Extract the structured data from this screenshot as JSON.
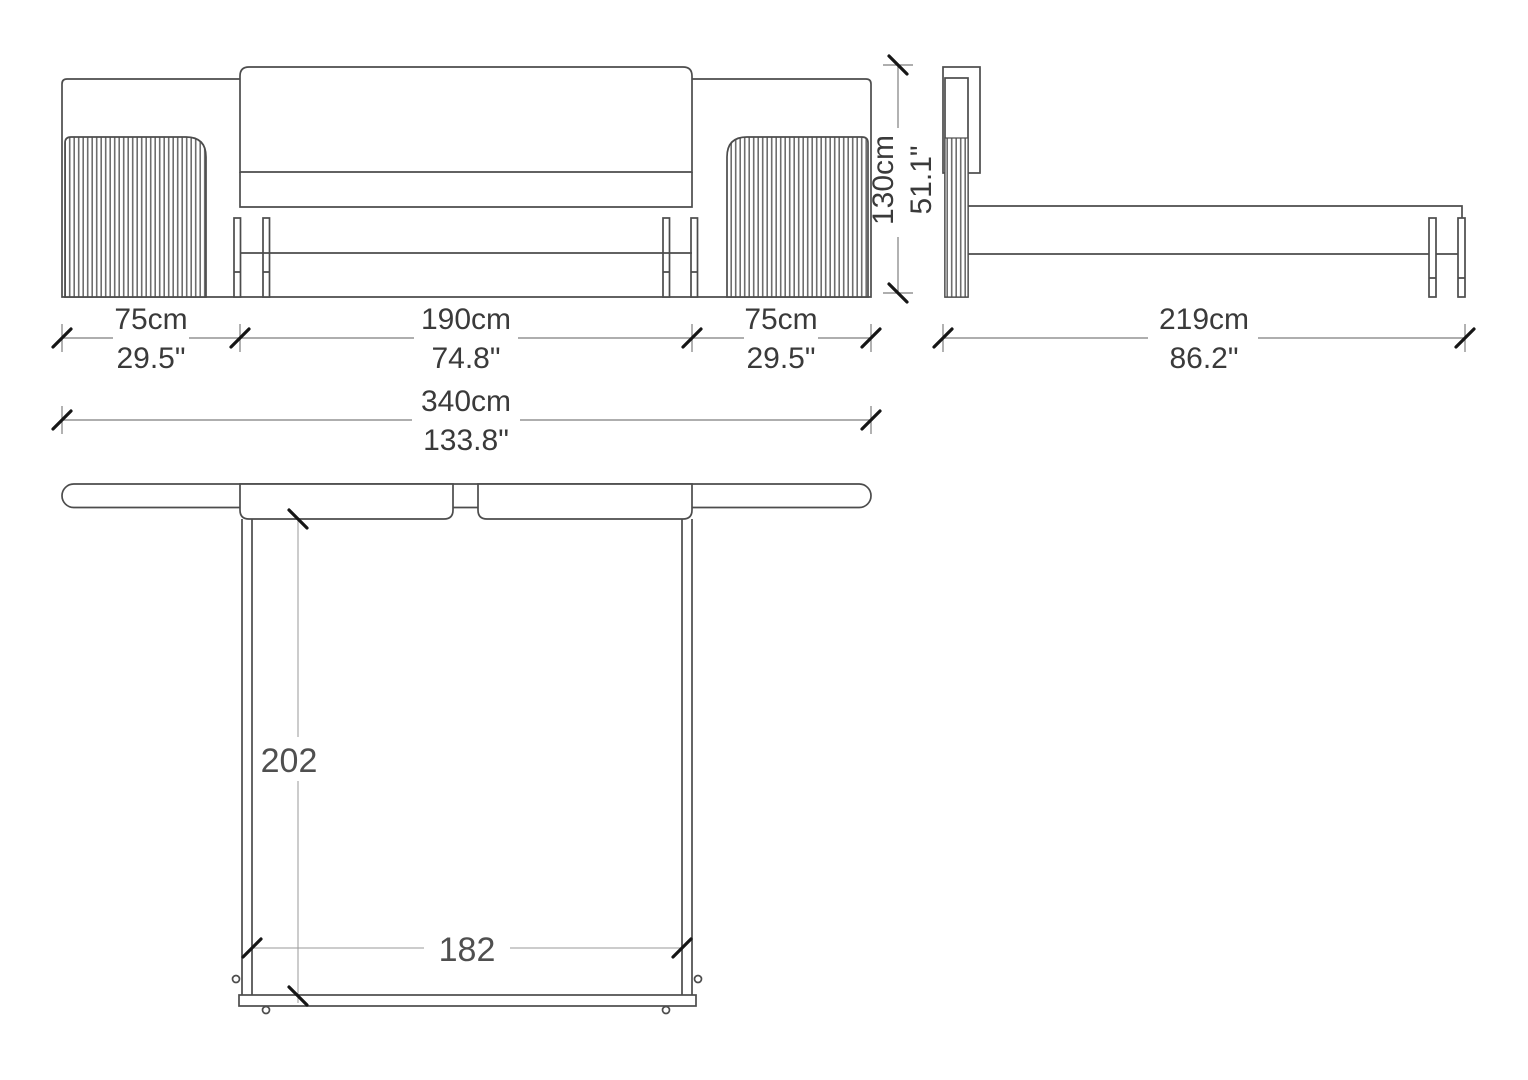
{
  "drawing": {
    "type": "bed-technical-drawing"
  },
  "dims": {
    "left": {
      "cm": "75cm",
      "inch": "29.5\""
    },
    "center": {
      "cm": "190cm",
      "inch": "74.8\""
    },
    "right": {
      "cm": "75cm",
      "inch": "29.5\""
    },
    "total": {
      "cm": "340cm",
      "inch": "133.8\""
    },
    "height": {
      "cm": "130cm",
      "inch": "51.1\""
    },
    "depth": {
      "cm": "219cm",
      "inch": "86.2\""
    },
    "plan_length_cm": "202",
    "plan_width_cm": "182"
  },
  "colors": {
    "background": "#ffffff",
    "outline": "#4c4c4c",
    "dimension_line": "#7e7e7e",
    "tick": "#161616",
    "text": "#3a3a3a",
    "flute_stripe": "#6e6e6e"
  }
}
